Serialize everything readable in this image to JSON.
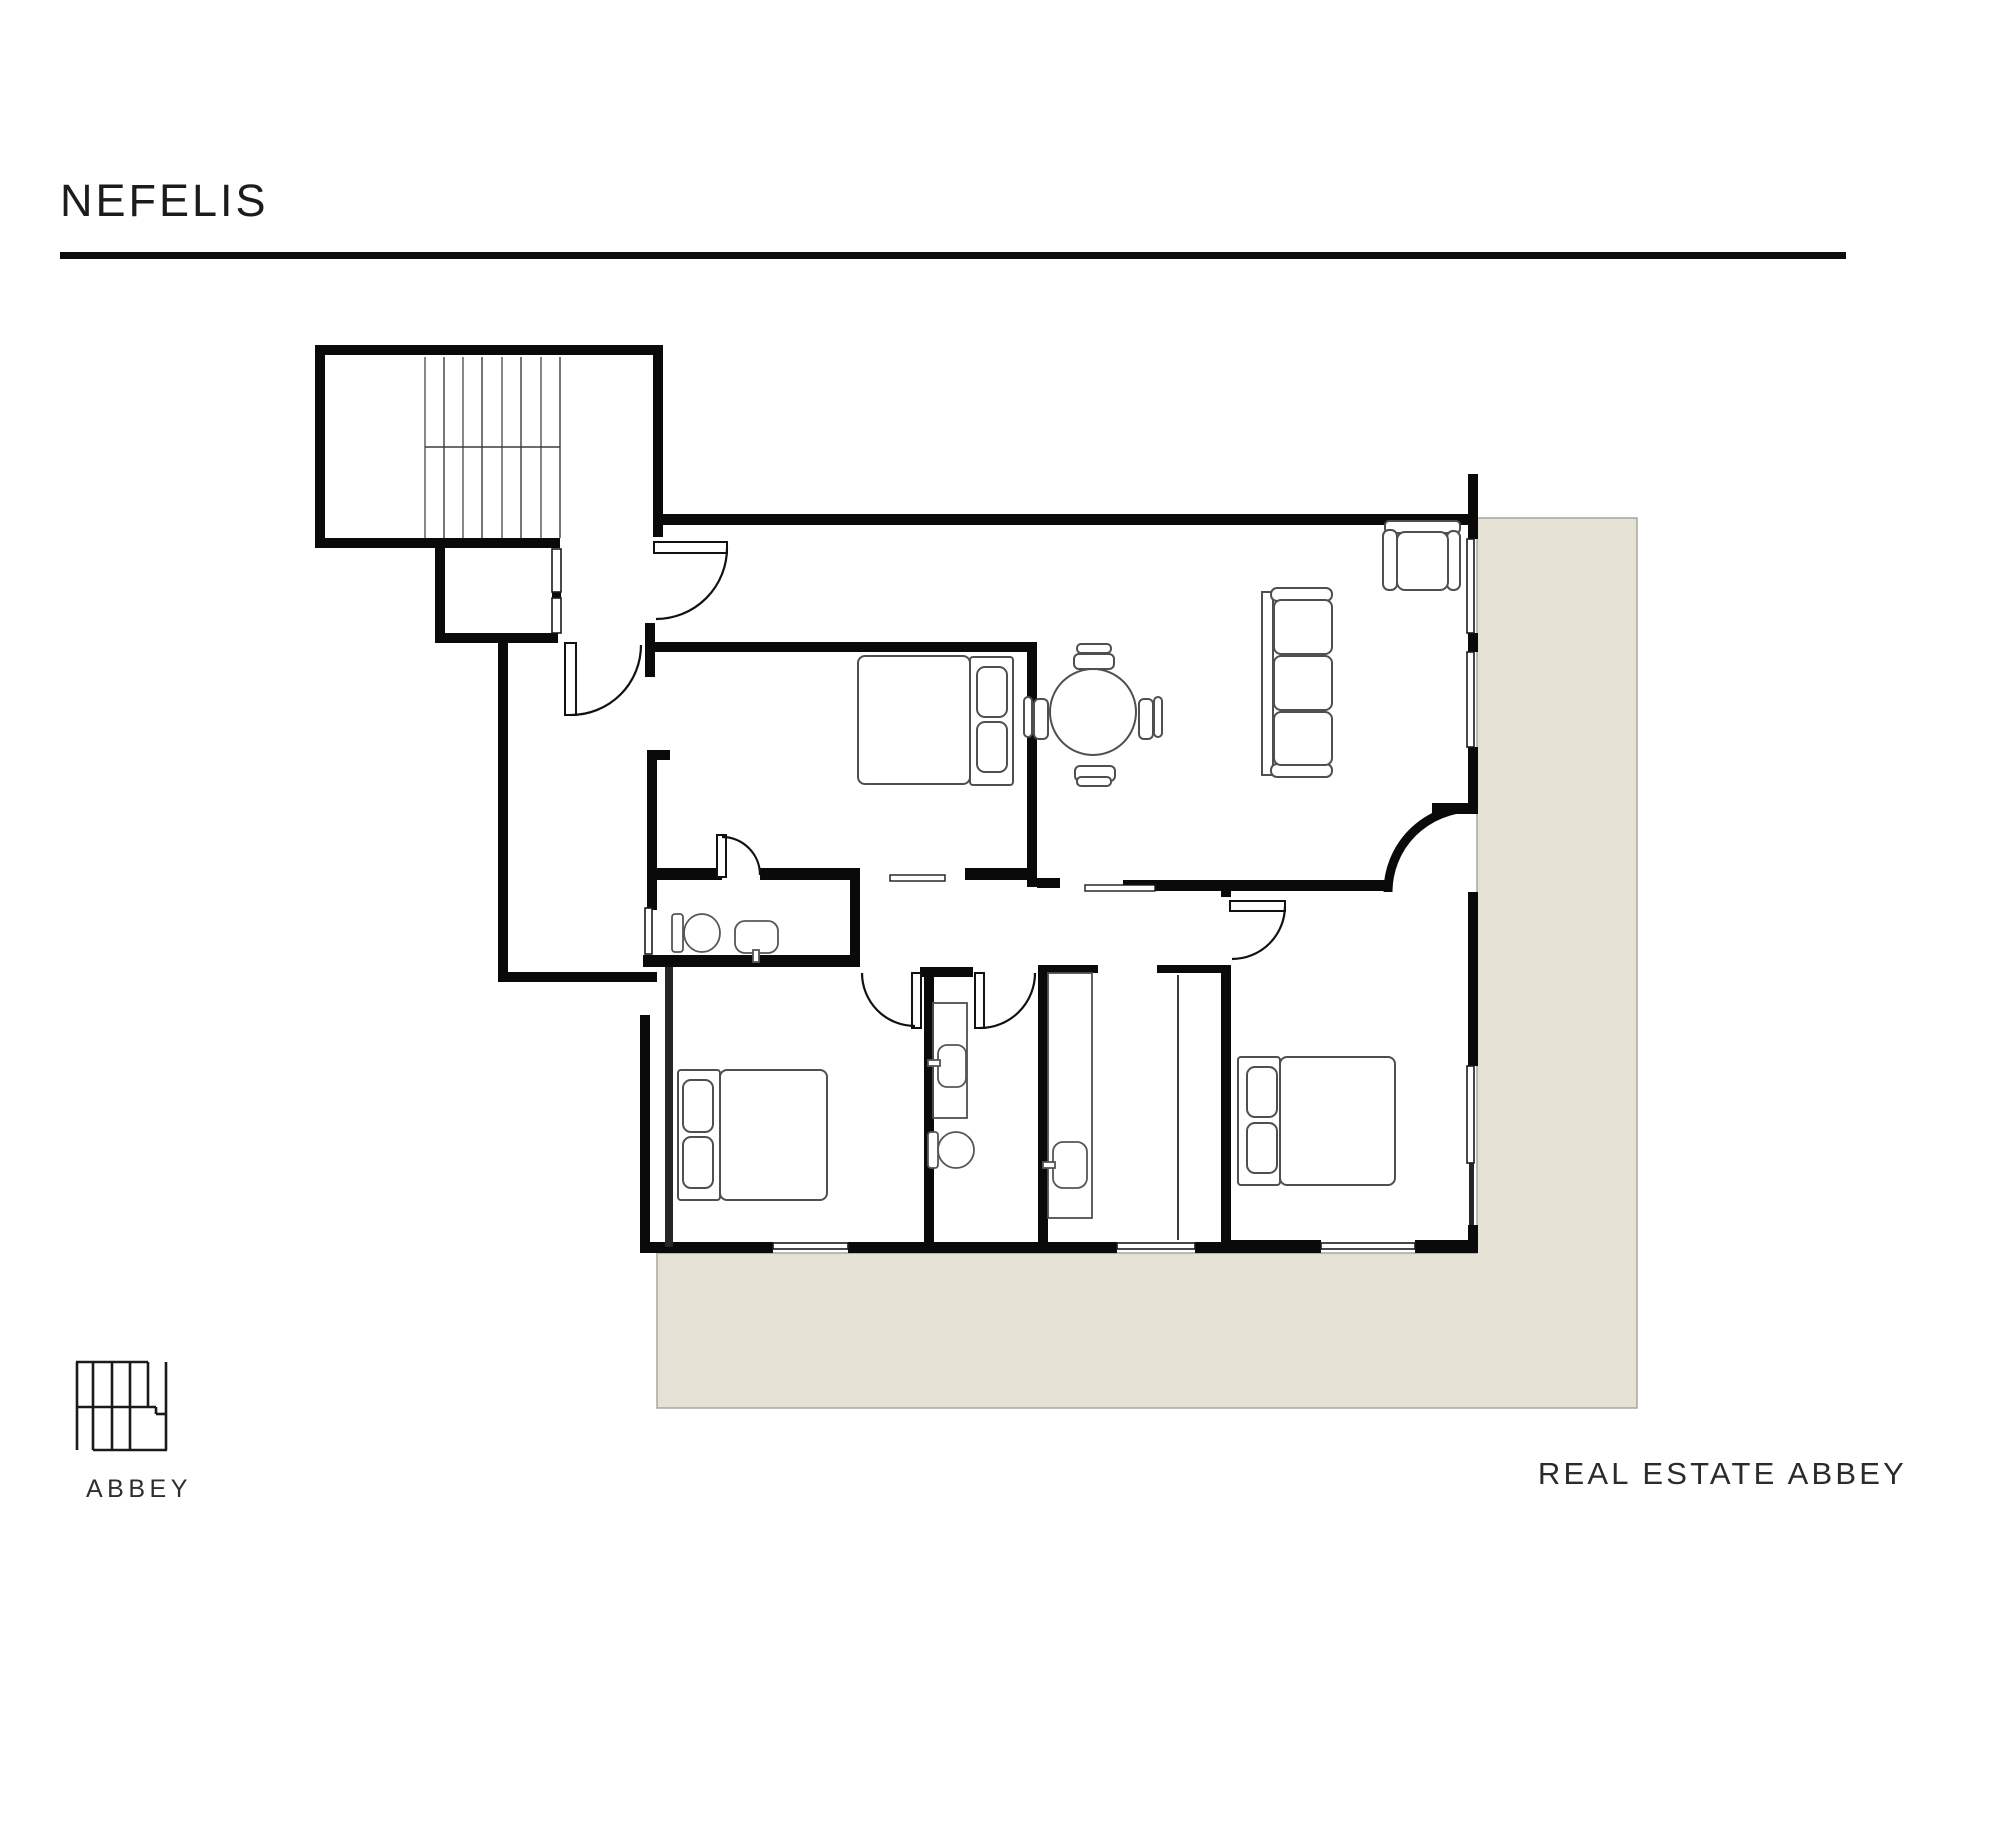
{
  "page": {
    "width": 2000,
    "height": 1828,
    "background": "#ffffff"
  },
  "header": {
    "title": "NEFELIS",
    "title_color": "#1c1c1c",
    "divider_color": "#0d0d0d"
  },
  "branding": {
    "logo_icon": "abbey-grid-logo",
    "logo_text": "ABBEY",
    "logo_color": "#1a1a1a"
  },
  "footer": {
    "agency_name": "REAL ESTATE ABBEY",
    "color": "#2b2b2b"
  },
  "floor_plan": {
    "type": "apartment-floor-plan",
    "colors": {
      "wall": "#0a0a0a",
      "terrace": "#e5e2d5",
      "terrace_border": "#a8a69b",
      "furniture_outline": "#4f4f4f",
      "stairs": "#7a7a7a",
      "door": "#111111"
    },
    "features": [
      "staircase",
      "stair-landing",
      "entry-door",
      "hall-door",
      "living-room",
      "sofa",
      "armchair",
      "dining-table-with-4-chairs",
      "bedroom-1-double-bed",
      "ensuite-wc-toilet-sink",
      "bedroom-2-double-bed",
      "wc-vanity-toilet",
      "bathroom-vanity-shower",
      "bedroom-3-double-bed",
      "windows",
      "terrace"
    ]
  }
}
